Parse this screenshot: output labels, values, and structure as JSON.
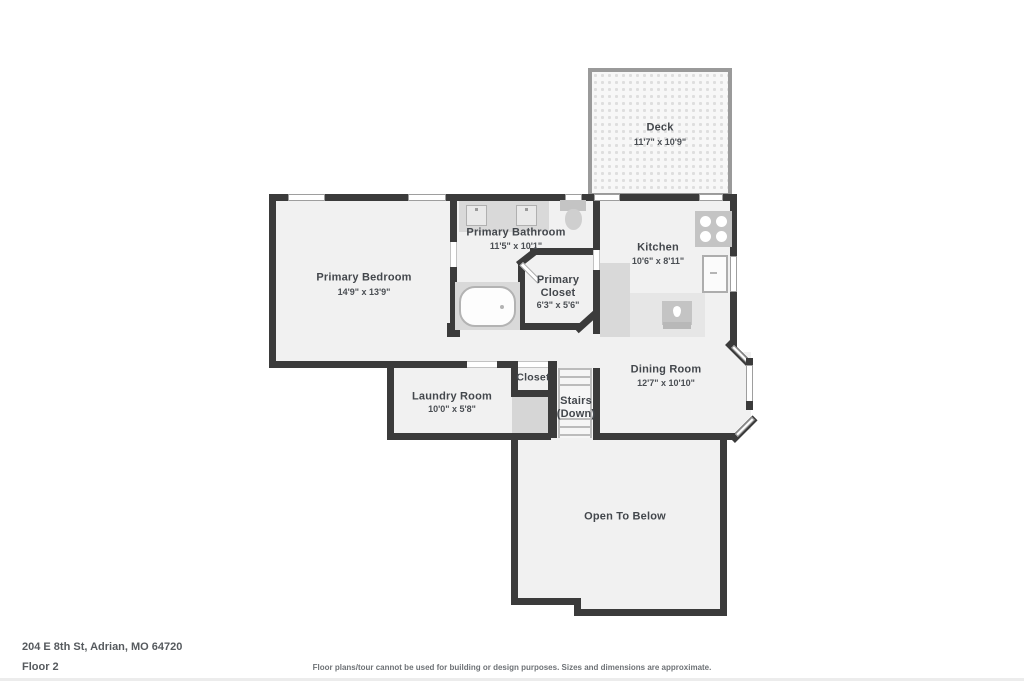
{
  "footer": {
    "address": "204 E 8th St, Adrian, MO 64720",
    "floor": "Floor 2",
    "disclaimer": "Floor plans/tour cannot be used for building or design purposes. Sizes and dimensions are approximate."
  },
  "colors": {
    "wall": "#3b3b3b",
    "room_fill": "#f1f1f1",
    "fixture_gray": "#d9d9d9",
    "deck_border": "#9a9a9a",
    "label_text": "#43474c"
  },
  "rooms": {
    "deck": {
      "name": "Deck",
      "dims": "11'7\" x 10'9\""
    },
    "primary_bedroom": {
      "name": "Primary Bedroom",
      "dims": "14'9\" x 13'9\""
    },
    "primary_bathroom": {
      "name": "Primary Bathroom",
      "dims": "11'5\" x 10'1\""
    },
    "primary_closet": {
      "name": "Primary Closet",
      "dims": "6'3\" x 5'6\""
    },
    "kitchen": {
      "name": "Kitchen",
      "dims": "10'6\" x 8'11\""
    },
    "dining_room": {
      "name": "Dining Room",
      "dims": "12'7\" x 10'10\""
    },
    "laundry_room": {
      "name": "Laundry Room",
      "dims": "10'0\" x 5'8\""
    },
    "closet": {
      "name": "Closet"
    },
    "stairs": {
      "name": "Stairs (Down)"
    },
    "open_to_below": {
      "name": "Open To Below"
    }
  },
  "fixtures": [
    "bathtub",
    "toilet",
    "vanity-double-sink",
    "stove",
    "refrigerator",
    "kitchen-sink",
    "stairs-steps",
    "bay-window",
    "deck-decking"
  ]
}
